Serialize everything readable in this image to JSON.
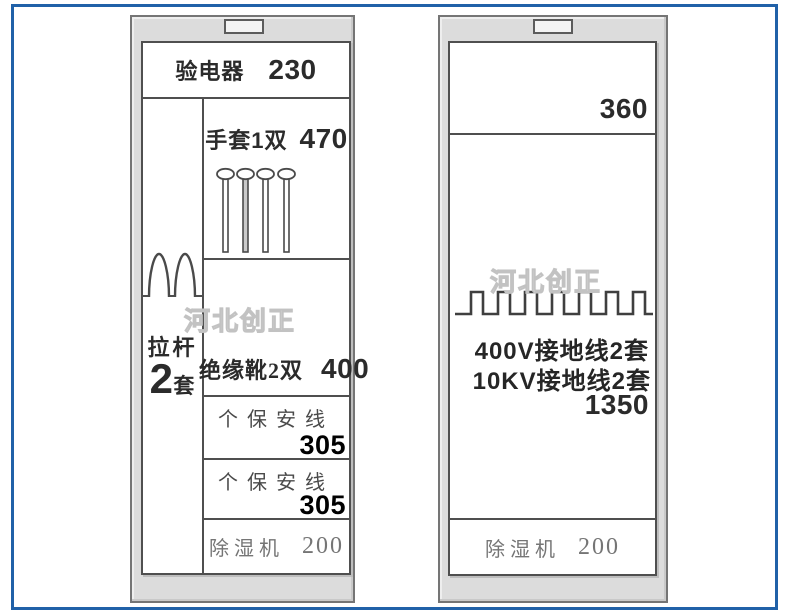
{
  "watermark": {
    "text": "河北创正"
  },
  "colors": {
    "frame_blue": "#2061a8",
    "cabinet_gray": "#dcdcdc",
    "line_dark": "#4f4f4f",
    "text_black": "#2b2b2b",
    "text_gray": "#757575"
  },
  "left_cabinet": {
    "electroscope": {
      "label": "验电器",
      "value": "230"
    },
    "gloves": {
      "label": "手套1双",
      "value": "470"
    },
    "pull_rod": {
      "label": "拉杆",
      "qty": "2",
      "unit": "套"
    },
    "boots": {
      "label": "绝缘靴2双",
      "value": "400"
    },
    "safety_lines": [
      {
        "label": "个保安线",
        "value": "305"
      },
      {
        "label": "个保安线",
        "value": "305"
      }
    ],
    "dehumidifier": {
      "label": "除湿机",
      "value": "200"
    }
  },
  "right_cabinet": {
    "top_shelf": {
      "value": "360"
    },
    "grounding": {
      "line1": "400V接地线2套",
      "line2": "10KV接地线2套",
      "value": "1350"
    },
    "dehumidifier": {
      "label": "除湿机",
      "value": "200"
    }
  }
}
